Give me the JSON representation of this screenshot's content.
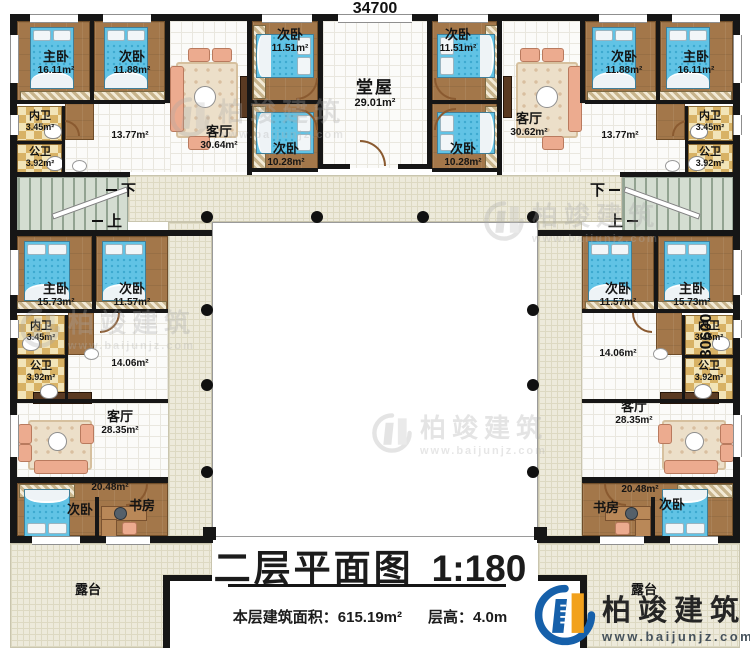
{
  "dimensions": {
    "top": "34700",
    "right": "30600"
  },
  "stairs": {
    "down": "下",
    "up": "上"
  },
  "watermark": {
    "brand": "柏竣建筑",
    "url": "www.baijunjz.com"
  },
  "logo": {
    "brand": "柏竣建筑",
    "url": "www.baijunjz.com"
  },
  "title": {
    "main": "二层平面图",
    "scale": "1:180",
    "area_label": "本层建筑面积：",
    "area_value": "615.19m²",
    "height_label": "层高：",
    "height_value": "4.0m"
  },
  "rooms": {
    "tl_master": {
      "name": "主卧",
      "area": "16.11m²"
    },
    "tl_bed2": {
      "name": "次卧",
      "area": "11.88m²"
    },
    "tl_living": {
      "name": "客厅",
      "area": "30.64m²"
    },
    "tl_bath_in": {
      "name": "内卫",
      "area": "3.45m²"
    },
    "tl_bath_pub": {
      "name": "公卫",
      "area": "3.92m²"
    },
    "tl_hall": {
      "area": "13.77m²"
    },
    "tc_bed_l1": {
      "name": "次卧",
      "area": "11.51m²"
    },
    "tc_bed_l2": {
      "name": "次卧",
      "area": "10.28m²"
    },
    "hall_main": {
      "name": "堂屋",
      "area": "29.01m²"
    },
    "tc_bed_r1": {
      "name": "次卧",
      "area": "11.51m²"
    },
    "tc_bed_r2": {
      "name": "次卧",
      "area": "10.28m²"
    },
    "tr_living": {
      "name": "客厅",
      "area": "30.62m²"
    },
    "tr_bed2": {
      "name": "次卧",
      "area": "11.88m²"
    },
    "tr_master": {
      "name": "主卧",
      "area": "16.11m²"
    },
    "tr_bath_in": {
      "name": "内卫",
      "area": "3.45m²"
    },
    "tr_bath_pub": {
      "name": "公卫",
      "area": "3.92m²"
    },
    "tr_hall": {
      "area": "13.77m²"
    },
    "ml_master": {
      "name": "主卧",
      "area": "15.73m²"
    },
    "ml_bed2": {
      "name": "次卧",
      "area": "11.57m²"
    },
    "ml_bath_in": {
      "name": "内卫",
      "area": "3.45m²"
    },
    "ml_bath_pub": {
      "name": "公卫",
      "area": "3.92m²"
    },
    "ml_hall": {
      "area": "14.06m²"
    },
    "mr_bed2": {
      "name": "次卧",
      "area": "11.57m²"
    },
    "mr_master": {
      "name": "主卧",
      "area": "15.73m²"
    },
    "mr_bath_in": {
      "name": "内卫",
      "area": "3.45m²"
    },
    "mr_bath_pub": {
      "name": "公卫",
      "area": "3.92m²"
    },
    "mr_hall": {
      "area": "14.06m²"
    },
    "bl_living": {
      "name": "客厅",
      "area": "28.35m²"
    },
    "bl_hall": {
      "area": "20.48m²"
    },
    "bl_bed": {
      "name": "次卧"
    },
    "bl_study": {
      "name": "书房"
    },
    "br_living": {
      "name": "客厅",
      "area": "28.35m²"
    },
    "br_hall": {
      "area": "20.48m²"
    },
    "br_study": {
      "name": "书房"
    },
    "br_bed": {
      "name": "次卧"
    },
    "terrace_l": {
      "name": "露台"
    },
    "terrace_r": {
      "name": "露台"
    }
  }
}
